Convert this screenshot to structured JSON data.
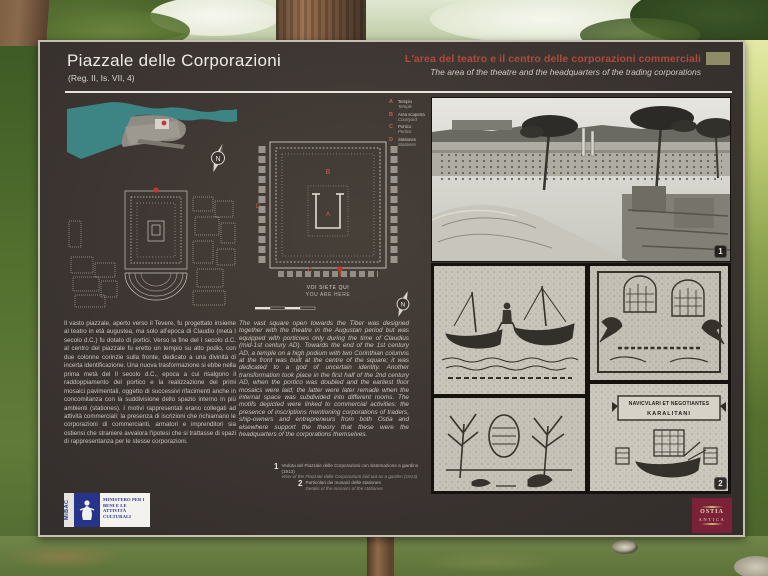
{
  "panel": {
    "title": "Piazzale delle Corporazioni",
    "subtitle": "(Reg. II, Is. VII, 4)",
    "header_right": {
      "title_it": "L'area del teatro e il centro delle corporazioni commerciali",
      "title_en": "The area of the theatre and the headquarters of the trading corporations"
    },
    "body_it": "Il vasto piazzale, aperto verso il Tevere, fu progettato insieme al teatro in età augustea, ma solo all'epoca di Claudio (metà I secolo d.C.) fu dotato di portici. Verso la fine del I secolo d.C. al centro del piazzale fu eretto un tempio su alto podio, con due colonne corinzie sulla fronte, dedicato a una divinità di incerta identificazione. Una nuova trasformazione si ebbe nella prima metà del II secolo d.C., epoca a cui risalgono il raddoppiamento del portico e la realizzazione dei primi mosaici pavimentali, oggetto di successivi rifacimenti anche in concomitanza con la suddivisione dello spazio interno in più ambienti (stationes). I motivi rappresentati erano collegati ad attività commerciali: la presenza di iscrizioni che richiamano le corporazioni di commercianti, armatori e imprenditori sia ostiensi che straniere avvalora l'ipotesi che si trattasse di spazi di rappresentanza per le stesse corporazioni.",
    "body_en": "The vast square open towards the Tiber was designed together with the theatre in the Augustan period but was equipped with porticoes only during the time of Claudius (mid-1st century AD). Towards the end of the 1st century AD, a temple on a high podium with two Corinthian columns at the front was built at the centre of the square; it was dedicated to a god of uncertain identity. Another transformation took place in the first half of the 2nd century AD, when the portico was doubled and the earliest floor mosaics were laid; the latter were later remade when the internal space was subdivided into different rooms. The motifs depicted were linked to commercial activities: the presence of inscriptions mentioning corporations of traders, ship-owners and entrepreneurs from both Ostia and elsewhere support the theory that these were the headquarters of the corporations themselves."
  },
  "legend": {
    "items": [
      {
        "letter": "A",
        "it": "Tempio",
        "en": "Temple"
      },
      {
        "letter": "B",
        "it": "Area scoperta",
        "en": "Courtyard"
      },
      {
        "letter": "C",
        "it": "Portico",
        "en": "Portico"
      },
      {
        "letter": "D",
        "it": "Stationes",
        "en": "Stationes"
      }
    ]
  },
  "map_labels": {
    "you_are_here_it": "VOI SIETE QUI",
    "you_are_here_en": "YOU ARE HERE",
    "compass_letter": "N"
  },
  "captions": [
    {
      "num": "1",
      "it": "Veduta del Piazzale delle Corporazioni con sistemazione a giardino (1913)",
      "en": "View of the Piazzale delle Corporazioni laid out as a garden (1913)"
    },
    {
      "num": "2",
      "it": "Particolari dei mosaici delle stationes",
      "en": "Details of the mosaics of the stationes"
    }
  ],
  "badges": {
    "photo1": "1",
    "photo2": "2"
  },
  "mosaics": {
    "inscription_line1": "NAVICVLARI ET NEGOTIANTES",
    "inscription_line2": "KARALITANI"
  },
  "logos": {
    "mibac": {
      "vertical": "MiBAC",
      "text": "MINISTERO PER I BENI E LE ATTIVITÀ CULTURALI"
    },
    "ostia": {
      "line1": "OSTIA",
      "line2": "ANTICA"
    }
  },
  "colors": {
    "panel_bg": "#3b3431",
    "accent_red": "#b04a3b",
    "marker_red": "#c4372c",
    "map_teal": "#3d8484",
    "olive_chip": "#8e8c66",
    "mibac_blue": "#27348b",
    "ostia_maroon": "#7b2138"
  }
}
